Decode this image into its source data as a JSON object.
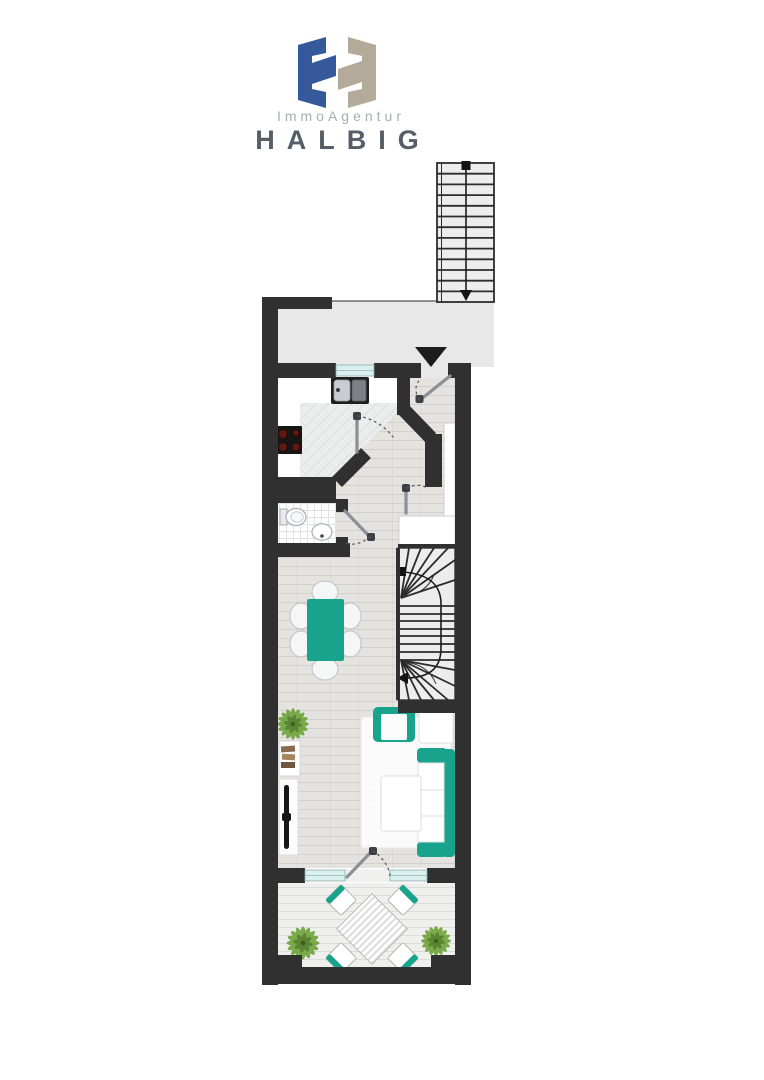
{
  "logo": {
    "agency_line": "ImmoAgentur",
    "name": "HALBIG"
  },
  "colors": {
    "wall": "#303030",
    "teal": "#18a48c",
    "glass": "#d8f0ee",
    "landing": "#e8e8e8",
    "stair": "#ededed",
    "wood_base": "#e4e3e0",
    "wood_line": "#d1d0cc",
    "terrace_base": "#efefed",
    "terrace_line": "#dcdcda",
    "marble": "#eceded",
    "marble_line": "#dddfdd",
    "tile_line": "#e2e2e2",
    "plant_green": "#6fa33c",
    "plant_dark": "#557f2d",
    "logo_blue": "#35599a",
    "logo_tan": "#b3aa9a",
    "label_gray": "#a9adb3",
    "title_gray": "#565e67",
    "arrow_black": "#1c1c1c"
  },
  "icons": {
    "entrance_arrow": "triangle-down",
    "stair_direction_start": "square",
    "stair_direction_end": "arrowhead"
  }
}
